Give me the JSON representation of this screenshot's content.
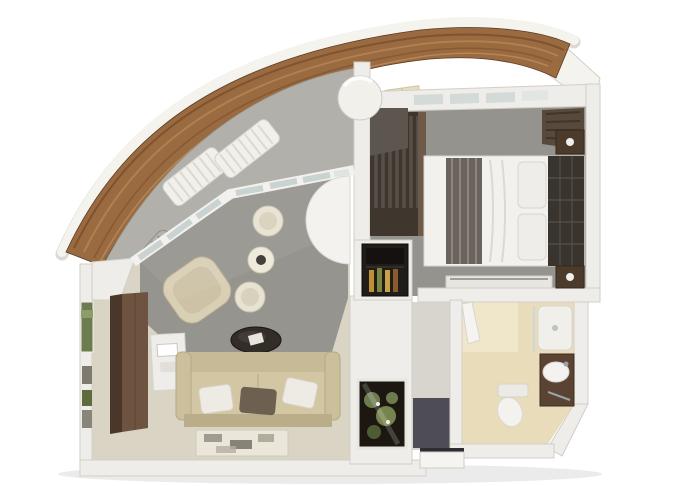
{
  "scene": {
    "description": "3D rendered floor plan of a ship suite with curved private balcony, living room, bedroom, bathroom and entry hall"
  },
  "colors": {
    "background": "#ffffff",
    "hull_white": "#f5f3ee",
    "wall": "#efede9",
    "wall_edge": "#d2cfc9",
    "wood_deck": "#9a6a40",
    "wood_deck_dark": "#6f4526",
    "balcony_deck": "#b2b0ab",
    "carpet_living": "#95948e",
    "floor_living": "#d9d4c4",
    "carpet_bedroom": "#94938d",
    "floor_bathroom": "#e9dcba",
    "floor_entry": "#4e4d55",
    "corridor_floor": "#d8d5cf",
    "glass": "#c9d4d2",
    "sofa": "#d2c6a3",
    "sofa_back": "#c6ba97",
    "pillow_dark": "#6e6051",
    "rug": "#eae6da",
    "coffee_table": "#332d28",
    "armchair": "#d9cfb4",
    "wardrobe": "#6e5440",
    "wood_furniture": "#4c3b2b",
    "minibar": "#201c18",
    "bottle_amber": "#bf8f33",
    "greenery": "#6d7c4f",
    "bed_linen": "#f3f1ed",
    "bed_runner": "#6a635b",
    "bed_headboard": "#3a342f",
    "dome": "#f2f0ea",
    "chrome": "#9aa2a6",
    "lounger_white": "#f2f0ea",
    "lounger_gray": "#b5b3ae"
  }
}
